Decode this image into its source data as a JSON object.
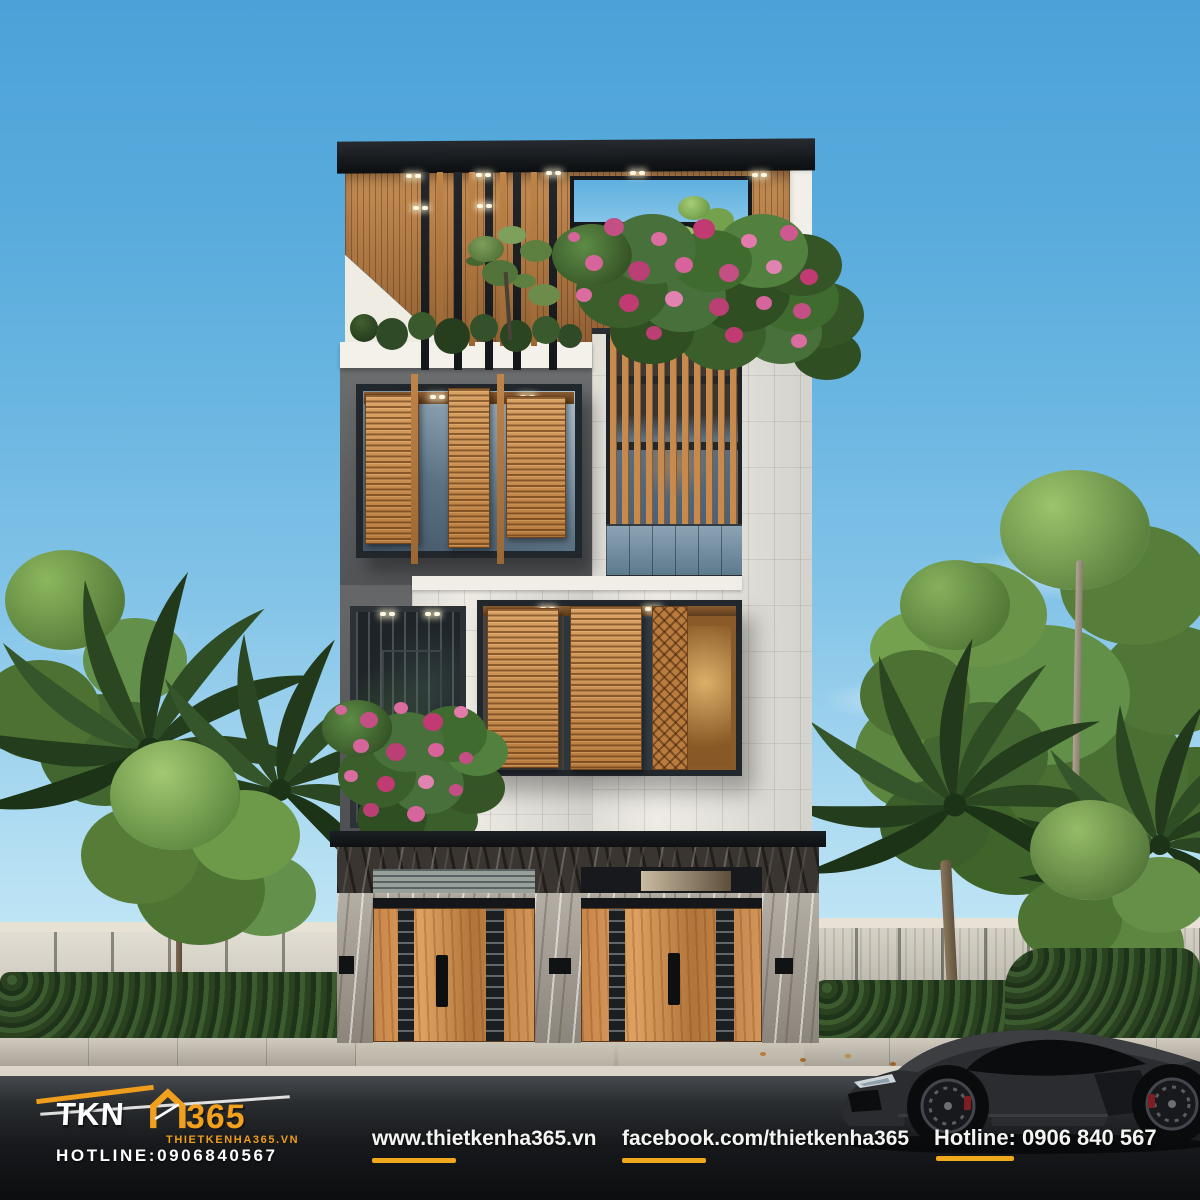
{
  "logo": {
    "brand": "TKN",
    "number": "365",
    "site": "THIETKENHA365.VN",
    "hotline": "HOTLINE:0906840567",
    "house_icon": "house-outline-icon"
  },
  "footer": {
    "website": "www.thietkenha365.vn",
    "facebook": "facebook.com/thietkenha365",
    "hotline": "Hotline: 0906 840 567"
  },
  "colors": {
    "accent_orange": "#F0A81C",
    "logo_orange": "#EF9D1C",
    "sky_top": "#4CA2D8",
    "sky_horizon": "#C6E8F6",
    "wood": "#C5854B",
    "facade_dark": "#5C5E60",
    "tile_white": "#EDEBE4",
    "flower_pink": "#D5659A",
    "road_dark": "#0C0D0F"
  }
}
